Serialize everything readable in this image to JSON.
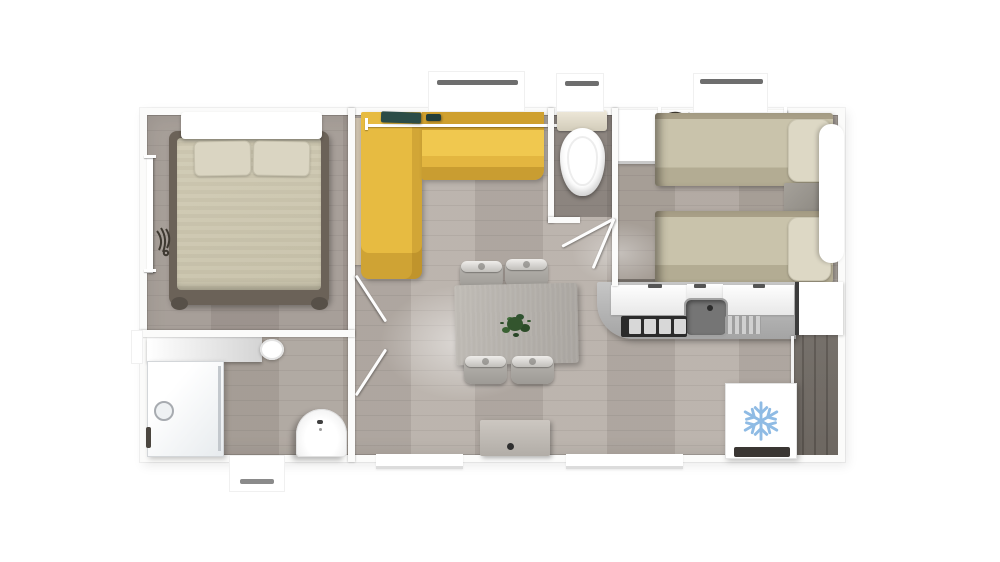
{
  "meta": {
    "title": "Mobile home floor plan — top-down 3D render",
    "canvas_width": 1000,
    "canvas_height": 562
  },
  "colors": {
    "canvas_bg": "#ffffff",
    "wall": "#fbfbfa",
    "floor_light": "#b7afa8",
    "floor_dark_room": "#6f6963",
    "sofa_yellow": "#e7bb41",
    "sofa_yellow_deep": "#cfa02f",
    "bed_beige": "#c7c1a9",
    "pillow_beige": "#dad5c2",
    "bed_frame_dark": "#6b6258",
    "wood_accent": "#d3c7b2",
    "table_gray": "#a8a49f",
    "chair_gray": "#b9b6b1",
    "plant_green": "#33552e",
    "appliance_dark": "#2b2b2b",
    "sink_gray": "#757575",
    "counter_gray": "#c6c6c6",
    "snowflake_blue": "#8fbbe4",
    "window_bar_gray": "#6e6e6e",
    "decor_teal": "#2b4c47"
  },
  "floorplan": {
    "rooms": [
      {
        "id": "master-bedroom",
        "furniture": [
          "double-bed",
          "white-headboard",
          "two-pillows",
          "wardrobe-rail-with-hangers"
        ]
      },
      {
        "id": "bathroom",
        "furniture": [
          "shower-cubicle",
          "vanity-counter",
          "vanity-sink",
          "pedestal-washbasin"
        ]
      },
      {
        "id": "living-dining",
        "furniture": [
          "l-shaped-yellow-sofa",
          "window-sill-decor",
          "dining-table",
          "four-chairs",
          "plant-centerpiece",
          "sideboard"
        ]
      },
      {
        "id": "wc",
        "furniture": [
          "toilet-with-cistern"
        ]
      },
      {
        "id": "twin-bedroom",
        "furniture": [
          "single-bed-top",
          "single-bed-bottom",
          "nightstand",
          "wardrobe",
          "clothes-rail-with-hangers",
          "headboard-panel"
        ]
      },
      {
        "id": "kitchen",
        "furniture": [
          "counter-with-rounded-end",
          "hob-4-burners",
          "sink-with-faucet",
          "drainer",
          "tall-cabinet",
          "refrigerator"
        ]
      }
    ],
    "icons": [
      {
        "name": "snowflake-icon",
        "meaning": "refrigerator / freezer"
      },
      {
        "name": "hangers-icon",
        "meaning": "wardrobe hanging space"
      }
    ],
    "doors": [
      "master-bedroom-door",
      "bathroom-door",
      "wc-door"
    ],
    "windows": [
      "top-living-window",
      "top-wc-window",
      "top-twin-window",
      "bottom-bathroom-window",
      "bottom-living-opening",
      "bottom-kitchen-opening",
      "left-bathroom-stub"
    ]
  }
}
